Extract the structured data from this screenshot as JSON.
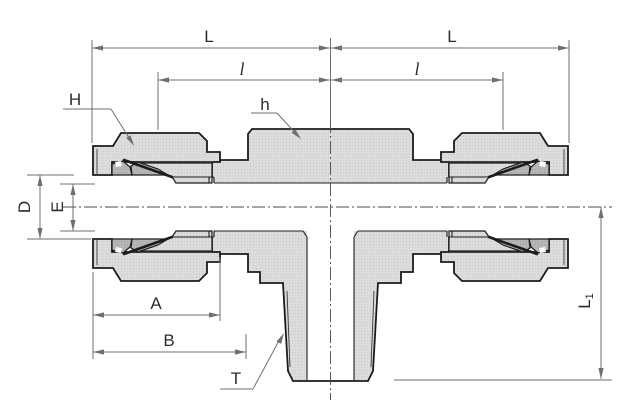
{
  "drawing": {
    "title": "compression-tee-fitting-cross-section",
    "labels": {
      "dim_L_left": "L",
      "dim_L_right": "L",
      "dim_l_left": "l",
      "dim_l_right": "l",
      "dim_H": "H",
      "dim_h": "h",
      "dim_D": "D",
      "dim_E": "E",
      "dim_A": "A",
      "dim_B": "B",
      "dim_T": "T",
      "dim_L1_main": "L",
      "dim_L1_sub": "1"
    },
    "colors": {
      "outline": "#1c1c1c",
      "body_fill": "#dcdcdc",
      "ferrule_fill": "#b6b6b6",
      "dimension": "#6f6f6f",
      "background": "#ffffff",
      "text": "#2b2b2b"
    }
  }
}
